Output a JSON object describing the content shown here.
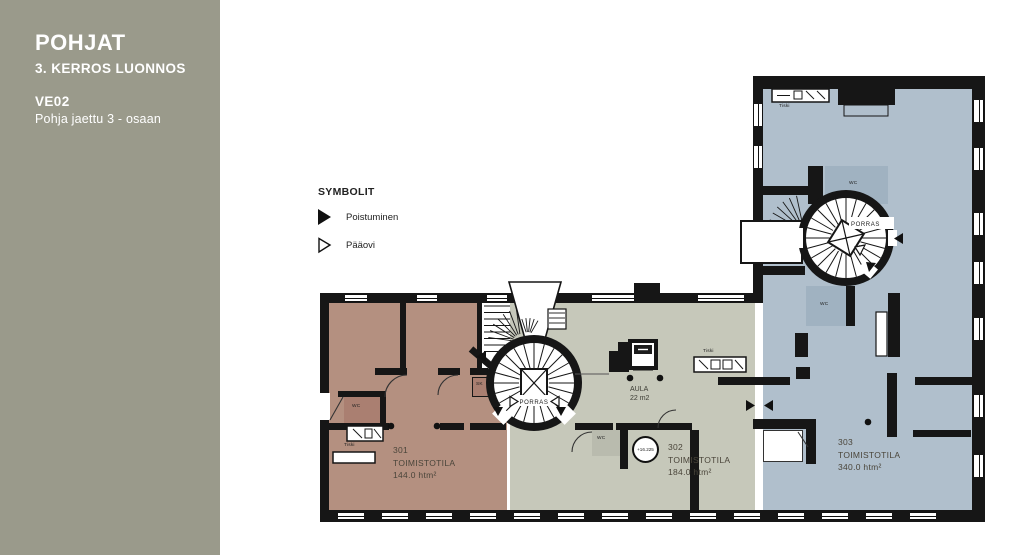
{
  "sidebar": {
    "title": "POHJAT",
    "subtitle": "3. KERROS LUONNOS",
    "version_code": "VE02",
    "version_desc": "Pohja jaettu 3 - osaan"
  },
  "legend": {
    "heading": "SYMBOLIT",
    "exit_label": "Poistuminen",
    "main_door_label": "Pääovi"
  },
  "rooms": {
    "r301": {
      "number": "301",
      "type": "TOIMISTOTILA",
      "area": "144.0 htm²"
    },
    "r302": {
      "number": "302",
      "type": "TOIMISTOTILA",
      "area": "184.0 htm²"
    },
    "r303": {
      "number": "303",
      "type": "TOIMISTOTILA",
      "area": "340.0 htm²"
    }
  },
  "plan_labels": {
    "aula": "AULA",
    "aula_area": "22 m2",
    "stair": "PORRAS",
    "wc": "WC",
    "closet": "SK",
    "counter": "Tiski",
    "elevation": "+16.225"
  },
  "colors": {
    "sidebar": "#9a9a8b",
    "room_301": "#b49080",
    "room_301_dark": "#aa7f71",
    "room_302": "#c6c8ba",
    "room_302_dark": "#b9bbae",
    "room_303": "#b0bfcc",
    "room_303_dark": "#a0b2c1",
    "wall": "#161616"
  }
}
